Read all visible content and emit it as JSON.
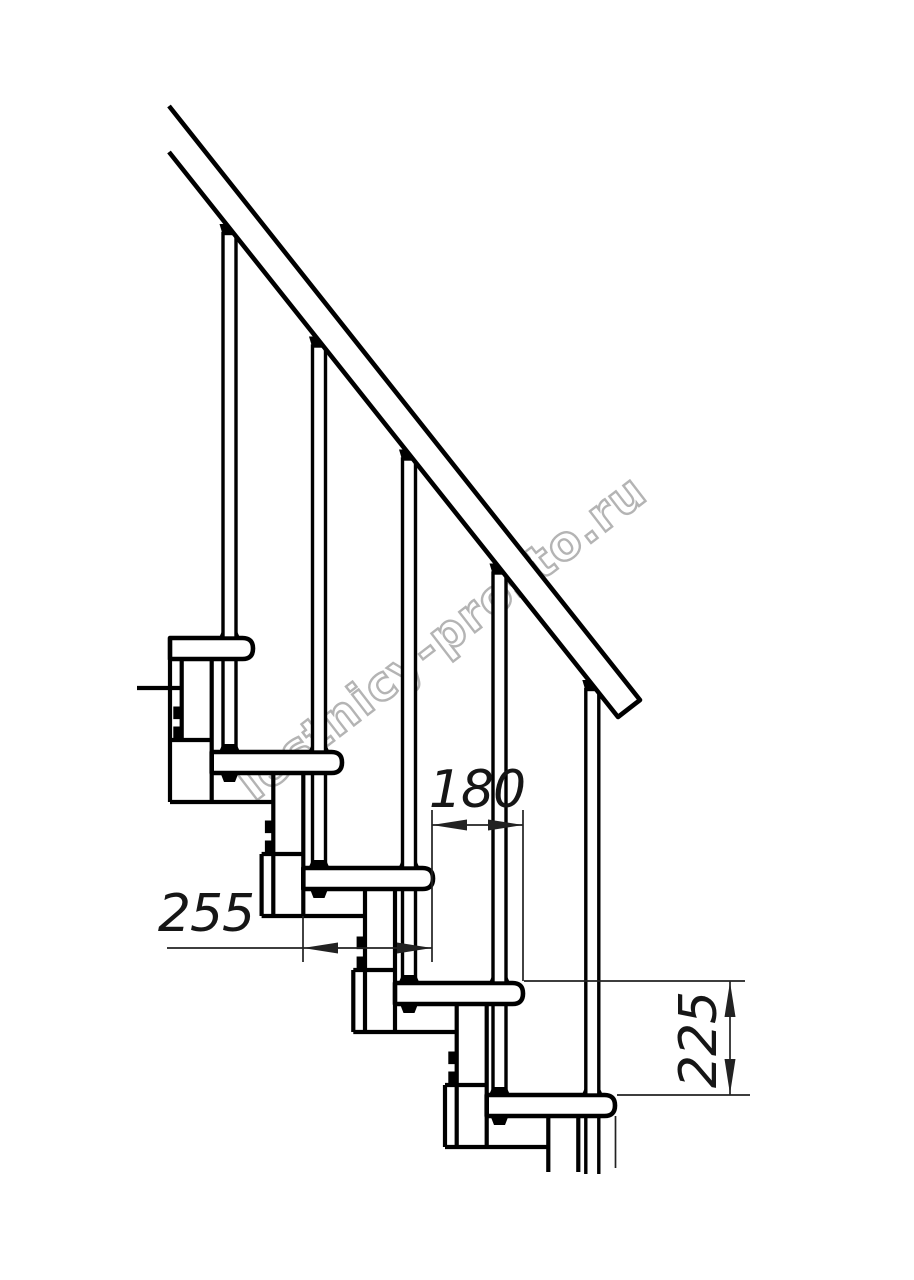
{
  "drawing": {
    "subject": "modular staircase side elevation",
    "tread_count": 5,
    "baluster_count": 5,
    "has_handrail": true,
    "ink_color": "#000000",
    "background_color": "#ffffff"
  },
  "dimensions": [
    {
      "label": "180",
      "orientation": "horizontal",
      "measures": "step going between tread nosings"
    },
    {
      "label": "255",
      "orientation": "horizontal",
      "measures": "tread depth"
    },
    {
      "label": "225",
      "orientation": "vertical",
      "measures": "step rise"
    }
  ],
  "watermark": {
    "text": "lestnicy-prosto.ru",
    "outline_color": "#b4b4b4"
  }
}
